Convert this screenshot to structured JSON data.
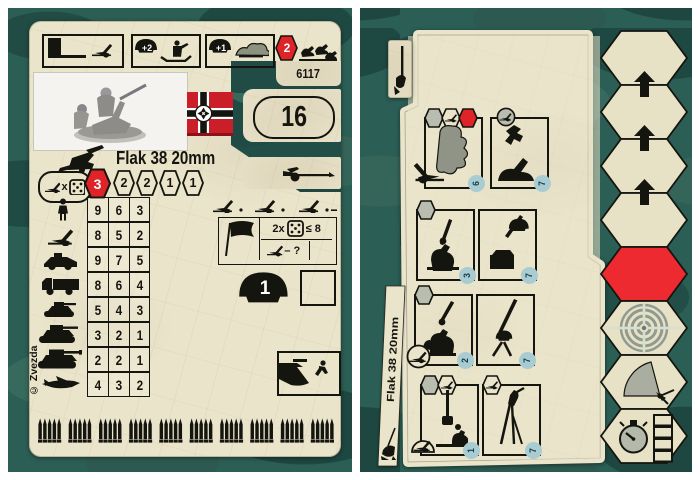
{
  "colors": {
    "camo_base": "#2b5e55",
    "card_paper": "#eae4cb",
    "accent_red": "#de2329",
    "ink": "#15150f",
    "step_blue": "#a9ccd3"
  },
  "left_card": {
    "product_number": "6117",
    "points_value": "16",
    "title": "Flak 38 20mm",
    "top_row": {
      "trench_bonus": "+2",
      "camouflage_bonus": "+1",
      "move_value": "2"
    },
    "attack_row": {
      "times_label": "x",
      "values": [
        "3",
        "2",
        "2",
        "1",
        "1"
      ]
    },
    "fire_table": {
      "rows": [
        {
          "unit": "infantry",
          "values": [
            "9",
            "6",
            "3"
          ]
        },
        {
          "unit": "anti-tank-gun",
          "values": [
            "8",
            "5",
            "2"
          ]
        },
        {
          "unit": "armored-car",
          "values": [
            "9",
            "7",
            "5"
          ]
        },
        {
          "unit": "truck",
          "values": [
            "8",
            "6",
            "4"
          ]
        },
        {
          "unit": "light-tank",
          "values": [
            "5",
            "4",
            "3"
          ]
        },
        {
          "unit": "medium-tank",
          "values": [
            "3",
            "2",
            "1"
          ]
        },
        {
          "unit": "heavy-tank",
          "values": [
            "2",
            "2",
            "1"
          ]
        },
        {
          "unit": "aircraft",
          "values": [
            "4",
            "3",
            "2"
          ]
        }
      ]
    },
    "assault_panel": {
      "double_label": "2x",
      "dice_limit_label": "≤ 8",
      "penalty_label": "– ?"
    },
    "strength_value": "1",
    "copyright": "© Zvezda"
  },
  "right_card": {
    "title": "Flak 38 20mm",
    "order_rows": [
      {
        "left_step": "6",
        "right_step": "7"
      },
      {
        "left_step": "3",
        "right_step": "7"
      },
      {
        "left_step": "2",
        "right_step": "7"
      },
      {
        "left_step": "1",
        "right_step": "7"
      }
    ]
  }
}
